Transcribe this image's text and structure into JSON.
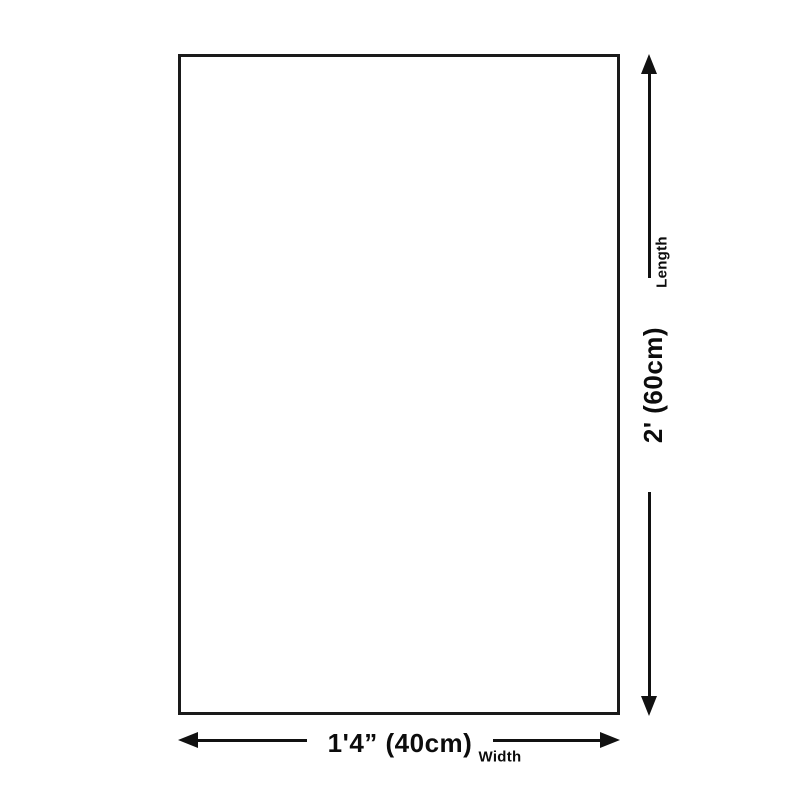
{
  "diagram": {
    "type": "product-dimension-diagram",
    "background_color": "#ffffff",
    "line_color": "#111111",
    "text_color": "#0c0c0c",
    "shape": "rectangle",
    "dimensions": {
      "length": {
        "label": "Length",
        "value": "2' (60cm)"
      },
      "width": {
        "label": "Width",
        "value": "1'4” (40cm)"
      }
    },
    "icons": {
      "vertical_arrow": [
        "arrow-up-icon",
        "arrow-down-icon"
      ],
      "horizontal_arrow": [
        "arrow-left-icon",
        "arrow-right-icon"
      ]
    }
  }
}
